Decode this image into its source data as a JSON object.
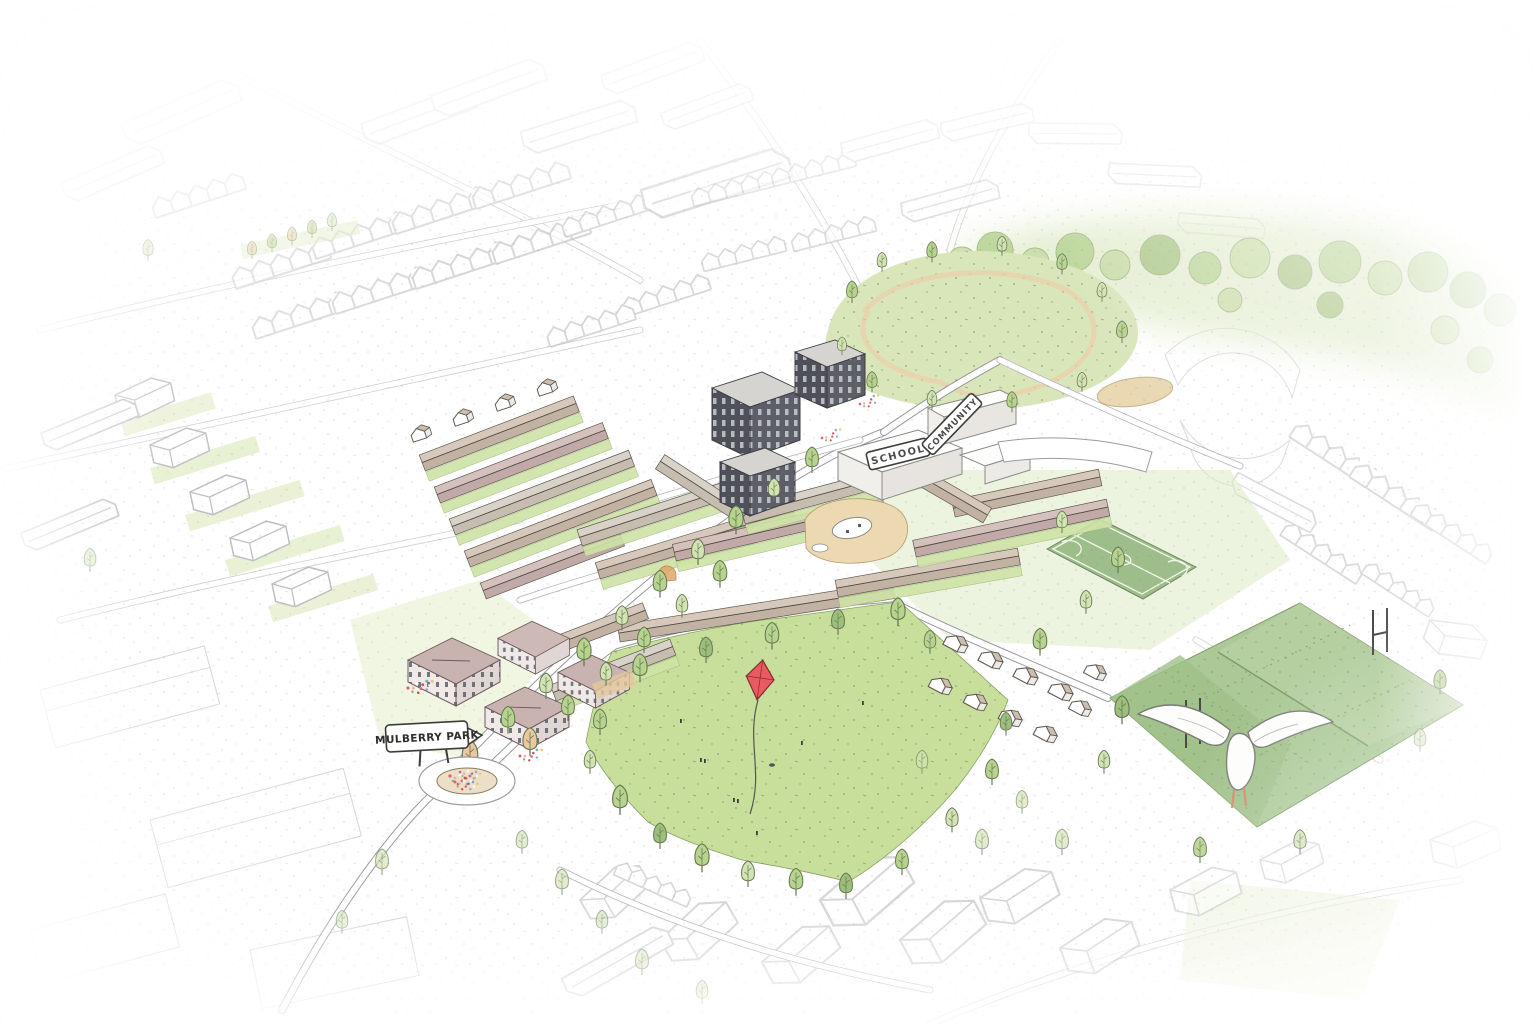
{
  "scene": {
    "title": "Mulberry Park neighbourhood masterplan - hand-drawn aerial illustration",
    "signs": {
      "park_sign": "MULBERRY PARK",
      "school_roof": "SCHOOL",
      "community_roof": "COMMUNITY"
    },
    "features": {
      "central_green": "central green with red kite flying",
      "rugby_pitch": "sports pitch with rugby posts and white seagull",
      "football_pitch": "marked football pitch",
      "landscaped_park": "park with winding paths and pond",
      "woodland_belt": "woodland belt along top edge",
      "school": "school building",
      "community_centre": "community building",
      "roundabout": "planted flower roundabout at park entrance",
      "new_housing": "terraced housing with rear gardens and street trees",
      "apartment_blocks": "three-storey apartment blocks",
      "context": "surrounding existing housing drawn as faded line work"
    },
    "colors": {
      "background": "#ffffff",
      "green_light": "#c7df9b",
      "green_park": "#d8e6ba",
      "green_pitch": "#abc996",
      "green_pitch_dark": "#a0c189",
      "green_muga": "#9dbd8a",
      "tree_green": "#b7d48e",
      "tree_pale": "#d3e4b4",
      "tree_orange": "#e9c9a0",
      "roof_taupe": "#d6c9bb",
      "roof_mauve": "#d4c0bc",
      "dark_facade": "#50505a",
      "path_sand": "#e7d5ae",
      "kite_red": "#ea5a60",
      "flower_pink": "#e06078",
      "ink": "#4a4a48",
      "context_line": "#aeaeb5"
    }
  }
}
